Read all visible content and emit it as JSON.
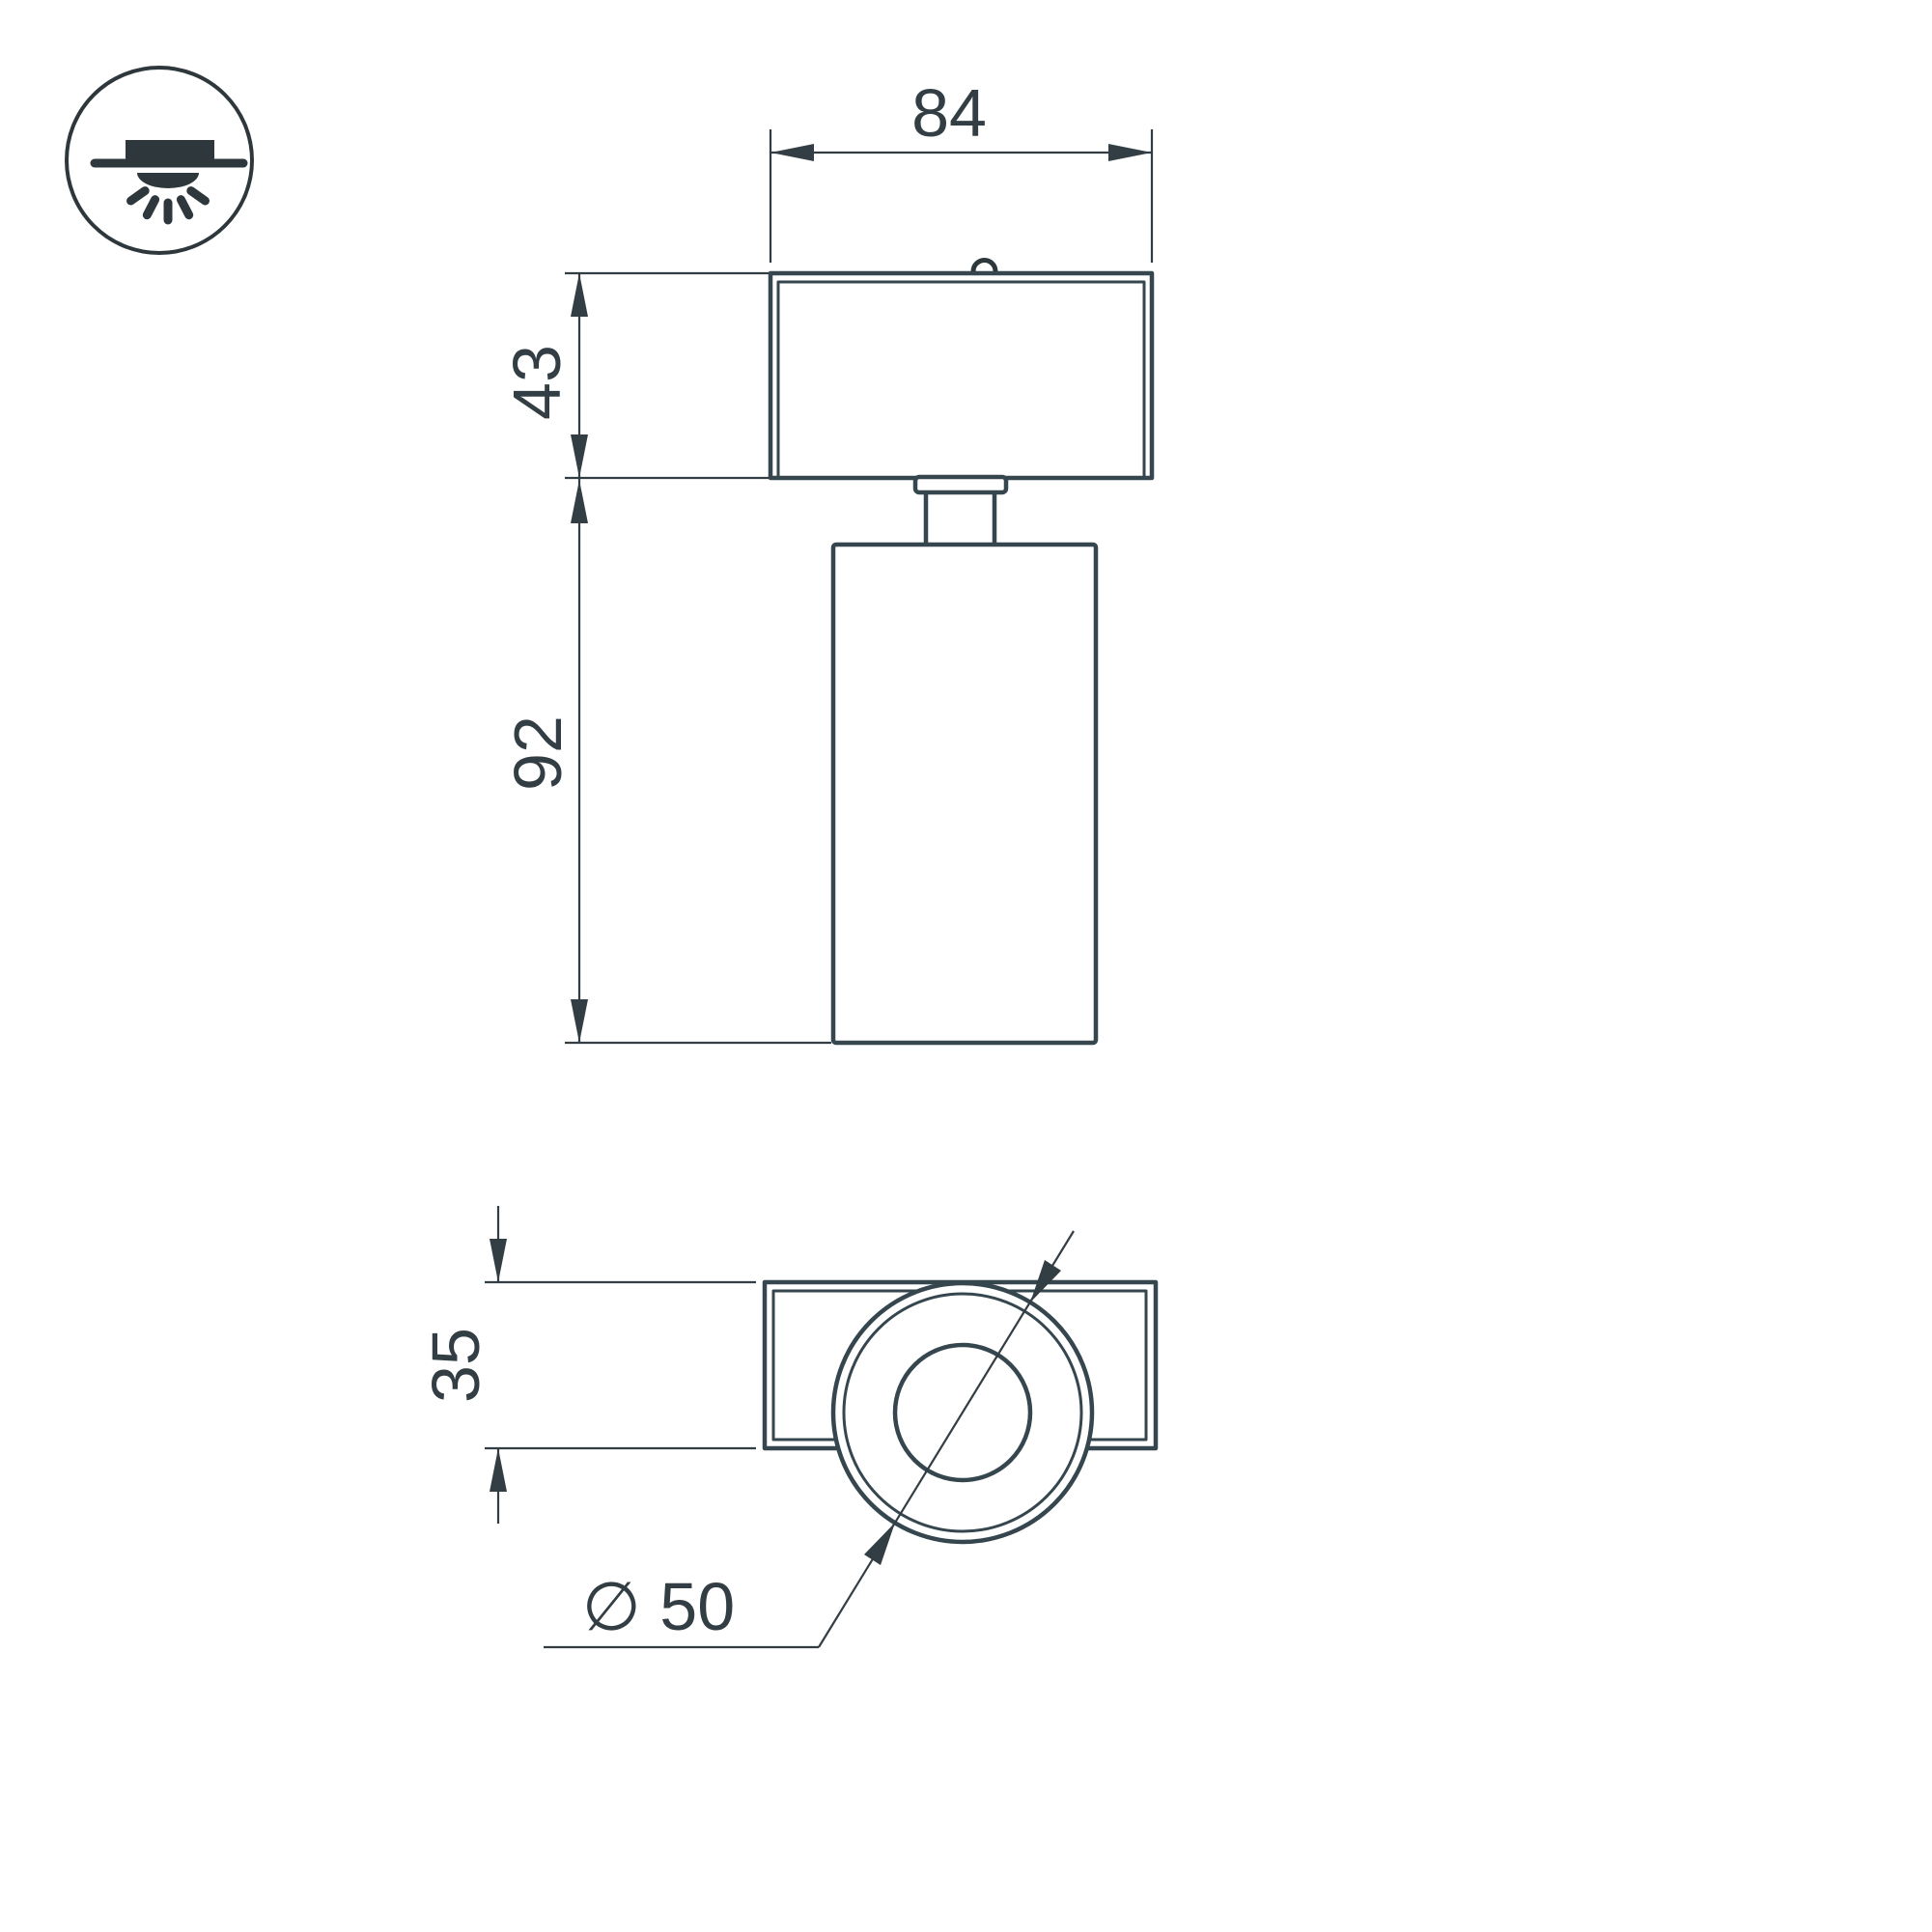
{
  "style": {
    "line-color": "#35464e",
    "dim-color": "#333e44",
    "icon-color": "#2e383c",
    "background": "#ffffff"
  },
  "icon": {
    "meaning": "surface-mounted-ceiling-light"
  },
  "views": {
    "front": "front-view",
    "bottom": "bottom-view"
  },
  "dimensions": {
    "top_width": {
      "label": "84"
    },
    "head_height": {
      "label": "43"
    },
    "body_height": {
      "label": "92"
    },
    "plate_depth": {
      "label": "35"
    },
    "body_diameter": {
      "label": "∅ 50"
    }
  }
}
